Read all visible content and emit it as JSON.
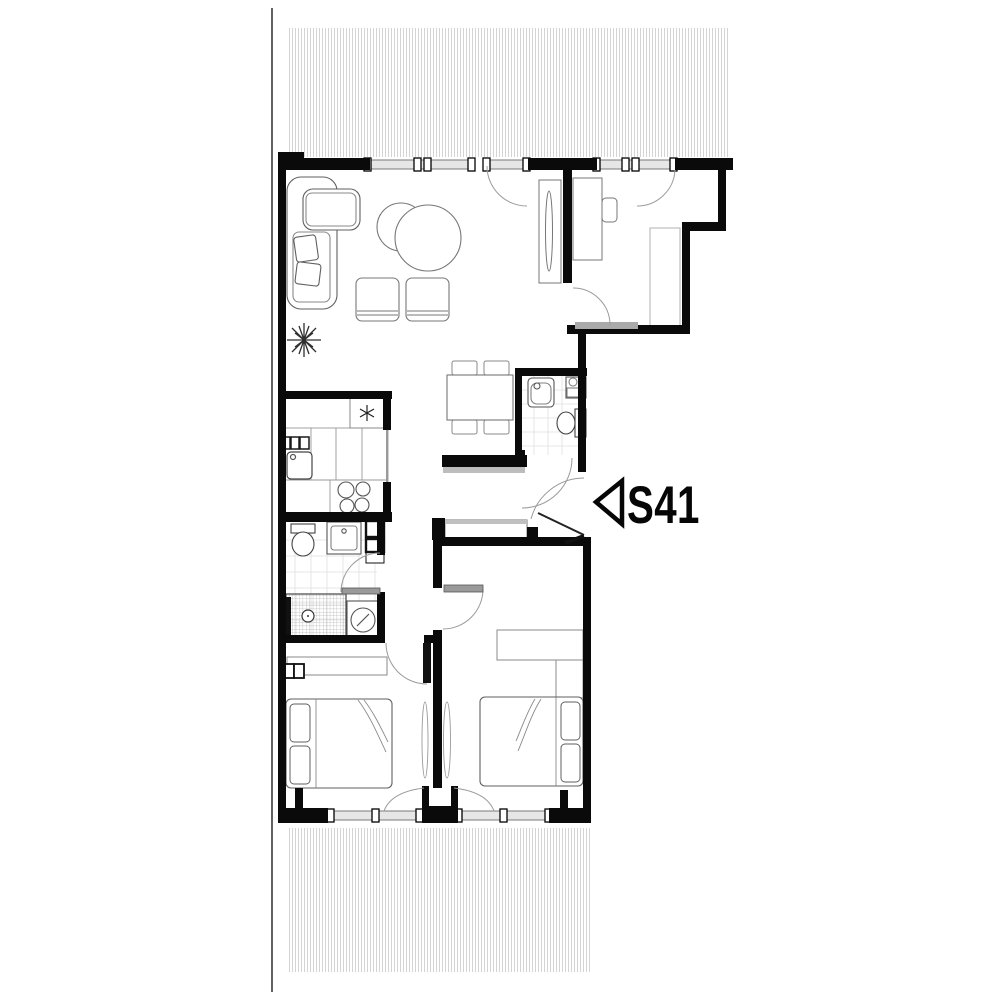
{
  "unit_marker": {
    "label": "S41",
    "icon": "triangle-left-icon",
    "color": "#060606"
  },
  "plan": {
    "type": "apartment-floor-plan",
    "rooms": [
      "terrace-top",
      "living-room",
      "study",
      "kitchen",
      "dining-area",
      "wc",
      "hallway",
      "bathroom",
      "bedroom-1",
      "bedroom-2",
      "terrace-bottom"
    ],
    "furniture_icons": [
      "corner-sofa",
      "coffee-tables",
      "ottoman",
      "plant",
      "tv-cabinet",
      "desk",
      "desk-chair",
      "closet",
      "fridge-snowflake",
      "kitchen-counter",
      "kitchen-sink",
      "cooktop",
      "dining-table",
      "dining-chair",
      "wc-sink",
      "wc-boiler",
      "toilet",
      "vanity-sink",
      "tall-cabinet",
      "shower",
      "washing-machine",
      "dresser",
      "radiator",
      "sideboard",
      "double-bed",
      "pillow",
      "wardrobe"
    ]
  },
  "colors": {
    "wall": "#0a0a0a",
    "furniture_line": "#5f5f5f",
    "light_line": "#9a9a9a",
    "hatch": "#c9c9c9",
    "glazing_fill": "#e6e6e6",
    "glazing_line": "#7a7a7a",
    "tile_line": "#e0e0e0",
    "door_arc": "#9b9b9b",
    "background": "#ffffff"
  }
}
